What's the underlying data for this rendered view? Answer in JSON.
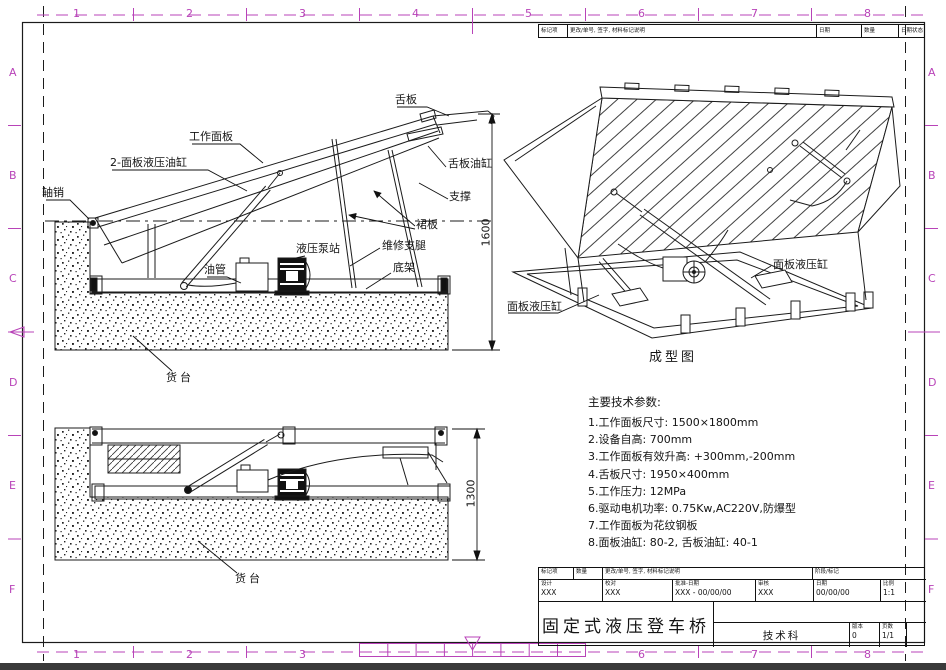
{
  "colors": {
    "accent": "#b843b8",
    "line": "#1b1b1b"
  },
  "border": {
    "top_numbers": [
      "1",
      "2",
      "3",
      "4",
      "5",
      "6",
      "7",
      "8"
    ],
    "bottom_numbers": [
      "1",
      "2",
      "3",
      "6",
      "7",
      "8"
    ],
    "left_letters": [
      "A",
      "B",
      "C",
      "D",
      "E",
      "F"
    ],
    "right_letters": [
      "A",
      "B",
      "C",
      "D",
      "E",
      "F"
    ]
  },
  "parts_strip": {
    "cells": [
      "标记项",
      "更改/单号, 签字, 材料标记说明",
      "日期",
      "数量",
      "日期状态"
    ]
  },
  "views": {
    "raised": {
      "labels": {
        "tongue": "舌板",
        "work_panel": "工作面板",
        "panel_cylinder": "2-面板液压油缸",
        "axle_pin": "轴销",
        "tongue_cylinder": "舌板油缸",
        "support": "支撑",
        "skirt": "裙板",
        "service_legs": "维修支腿",
        "pump_station": "液压泵站",
        "oil_pipe": "油管",
        "base_frame": "底架",
        "dock": "货台"
      },
      "dimension": "1600"
    },
    "lowered": {
      "labels": {
        "dock": "货台"
      },
      "dimension": "1300"
    },
    "isometric": {
      "caption": "成型图",
      "label_left": "面板液压缸",
      "label_right": "面板液压缸"
    }
  },
  "tech_params": {
    "title": "主要技术参数:",
    "items": [
      "1.工作面板尺寸: 1500×1800mm",
      "2.设备自高: 700mm",
      "3.工作面板有效升高: +300mm,-200mm",
      "4.舌板尺寸: 1950×400mm",
      "5.工作压力: 12MPa",
      "6.驱动电机功率: 0.75Kw,AC220V,防爆型",
      "7.工作面板为花纹钢板",
      "8.面板油缸: 80-2, 舌板油缸: 40-1"
    ]
  },
  "title_block": {
    "row_a": [
      "标记项",
      "数量",
      "更改/单号, 签字, 材料标记说明",
      "阶段/标记"
    ],
    "row_b": [
      {
        "label": "设计",
        "value": "XXX"
      },
      {
        "label": "校对",
        "value": "XXX"
      },
      {
        "label": "批准-日期",
        "value": "XXX - 00/00/00"
      },
      {
        "label": "审核",
        "value": "XXX"
      },
      {
        "label": "日期",
        "value": "00/00/00"
      },
      {
        "label": "比例",
        "value": "1:1"
      }
    ],
    "product_title": "固定式液压登车桥",
    "department": "技术科",
    "version_label": "版本",
    "version_value": "0",
    "sheet_label": "页数",
    "sheet_value": "1/1"
  }
}
